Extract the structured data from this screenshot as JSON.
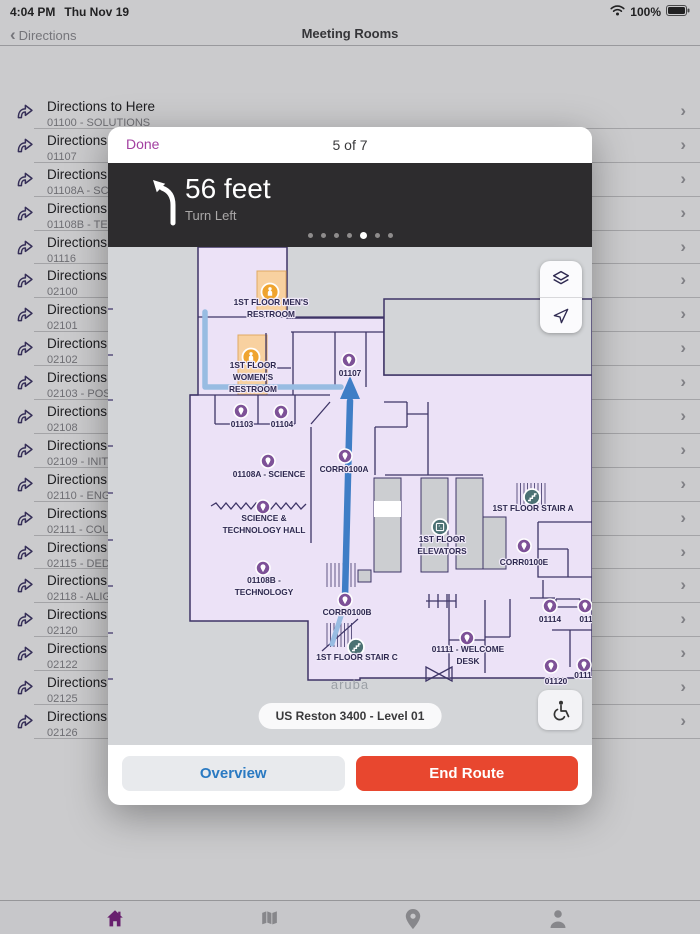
{
  "status_bar": {
    "time": "4:04 PM",
    "date": "Thu Nov 19",
    "battery_percent": "100%"
  },
  "nav_bar": {
    "back_label": "Directions",
    "title": "Meeting Rooms"
  },
  "room_list": {
    "item_title": "Directions to Here",
    "items": [
      "01100 - SOLUTIONS",
      "01107",
      "01108A - SCIENCE",
      "01108B - TECHNO",
      "01116",
      "02100",
      "02101",
      "02102",
      "02103 - POSSIBILI",
      "02108",
      "02109 - INITIATIVE",
      "02110 - ENGAGEM",
      "02111 - COURAGE",
      "02115 - DEDICATI",
      "02118 - ALIGNME",
      "02120",
      "02122",
      "02125",
      "02126"
    ]
  },
  "modal": {
    "done_label": "Done",
    "step_counter": "5 of 7",
    "instruction": {
      "distance": "56 feet",
      "action": "Turn Left",
      "dots_total": 7,
      "dots_active": 5
    },
    "map": {
      "floor_label": "US Reston 3400 - Level 01",
      "watermark": "aruba",
      "colors": {
        "floor": "#ece2f7",
        "walls": "#3e3567",
        "background": "#d3d5d8",
        "marker_purple": "#7d5197",
        "marker_orange": "#efa42f",
        "restroom_fill": "#f8d1a0",
        "facility_teal": "#4b7173",
        "route_current": "#3f7ec6",
        "route_other": "#98bce2"
      },
      "markers": [
        {
          "kind": "restroom",
          "x": 162,
          "y": 45,
          "label": {
            "x": 163,
            "y": 58,
            "lines": [
              "1ST FLOOR MEN'S",
              "RESTROOM"
            ]
          }
        },
        {
          "kind": "restroom",
          "x": 143,
          "y": 110,
          "label": {
            "x": 145,
            "y": 121,
            "lines": [
              "1ST FLOOR",
              "WOMEN'S",
              "RESTROOM"
            ]
          }
        },
        {
          "kind": "room",
          "x": 241,
          "y": 113,
          "label": {
            "x": 242,
            "y": 129,
            "lines": [
              "01107"
            ]
          }
        },
        {
          "kind": "room",
          "x": 133,
          "y": 164,
          "label": {
            "x": 134,
            "y": 180,
            "lines": [
              "01103"
            ]
          }
        },
        {
          "kind": "room",
          "x": 173,
          "y": 165,
          "label": {
            "x": 174,
            "y": 180,
            "lines": [
              "01104"
            ]
          }
        },
        {
          "kind": "room",
          "x": 237,
          "y": 209,
          "label": {
            "x": 236,
            "y": 225,
            "lines": [
              "CORR0100A"
            ]
          }
        },
        {
          "kind": "room",
          "x": 160,
          "y": 214,
          "label": {
            "x": 161,
            "y": 230,
            "lines": [
              "01108A - SCIENCE"
            ]
          }
        },
        {
          "kind": "room",
          "x": 155,
          "y": 260,
          "label": {
            "x": 156,
            "y": 274,
            "lines": [
              "SCIENCE &",
              "TECHNOLOGY HALL"
            ]
          }
        },
        {
          "kind": "room",
          "x": 155,
          "y": 321,
          "label": {
            "x": 156,
            "y": 336,
            "lines": [
              "01108B -",
              "TECHNOLOGY"
            ]
          }
        },
        {
          "kind": "room",
          "x": 237,
          "y": 353,
          "label": {
            "x": 239,
            "y": 368,
            "lines": [
              "CORR0100B"
            ]
          }
        },
        {
          "kind": "stairs",
          "x": 248,
          "y": 400,
          "label": {
            "x": 249,
            "y": 413,
            "lines": [
              "1ST FLOOR STAIR C"
            ]
          }
        },
        {
          "kind": "elevator",
          "x": 332,
          "y": 280,
          "label": {
            "x": 334,
            "y": 295,
            "lines": [
              "1ST FLOOR",
              "ELEVATORS"
            ]
          }
        },
        {
          "kind": "stairs",
          "x": 424,
          "y": 250,
          "label": {
            "x": 425,
            "y": 264,
            "lines": [
              "1ST FLOOR STAIR A"
            ]
          }
        },
        {
          "kind": "room",
          "x": 416,
          "y": 299,
          "label": {
            "x": 416,
            "y": 318,
            "lines": [
              "CORR0100E"
            ]
          }
        },
        {
          "kind": "room",
          "x": 442,
          "y": 359,
          "label": {
            "x": 442,
            "y": 375,
            "lines": [
              "01114"
            ]
          }
        },
        {
          "kind": "room",
          "x": 477,
          "y": 359,
          "label": {
            "x": 478,
            "y": 375,
            "lines": [
              "011"
            ]
          }
        },
        {
          "kind": "room",
          "x": 359,
          "y": 391,
          "label": {
            "x": 360,
            "y": 405,
            "lines": [
              "01111 - WELCOME",
              "DESK"
            ]
          }
        },
        {
          "kind": "room",
          "x": 443,
          "y": 419,
          "label": {
            "x": 448,
            "y": 437,
            "lines": [
              "01120"
            ]
          }
        },
        {
          "kind": "room",
          "x": 476,
          "y": 418,
          "label": {
            "x": 475,
            "y": 431,
            "lines": [
              "0111"
            ]
          }
        }
      ]
    },
    "overview_label": "Overview",
    "end_route_label": "End Route"
  },
  "tab_bar": {
    "tabs": [
      {
        "name": "home",
        "active": true
      },
      {
        "name": "map",
        "active": false
      },
      {
        "name": "locations",
        "active": false
      },
      {
        "name": "profile",
        "active": false
      }
    ]
  }
}
